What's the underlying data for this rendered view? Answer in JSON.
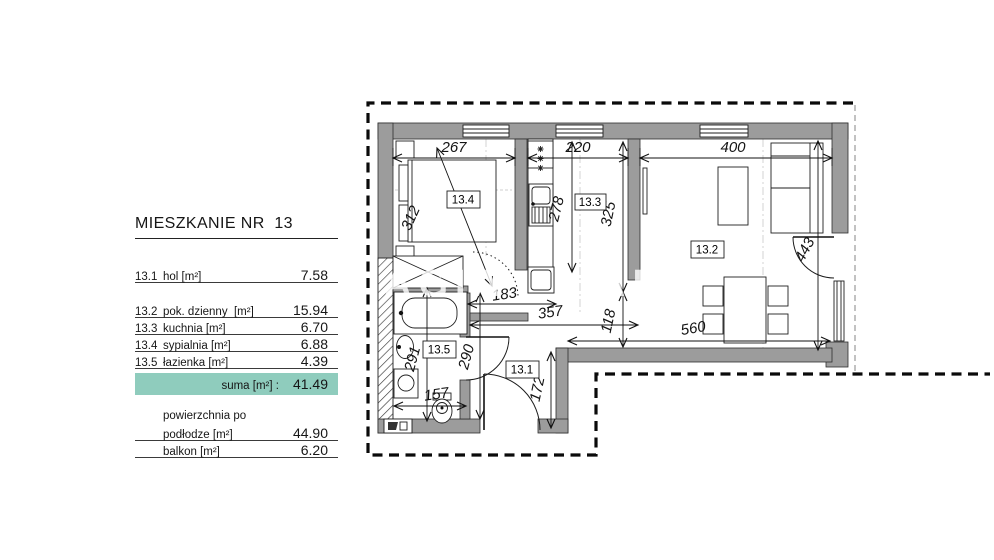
{
  "legend": {
    "title": "MIESZKANIE NR  13",
    "rows": [
      {
        "no": "13.1",
        "name": "hol [m²]",
        "value": "7.58"
      },
      {
        "no": "13.2",
        "name": "pok. dzienny  [m²]",
        "value": "15.94"
      },
      {
        "no": "13.3",
        "name": "kuchnia [m²]",
        "value": "6.70"
      },
      {
        "no": "13.4",
        "name": "sypialnia [m²]",
        "value": "6.88"
      },
      {
        "no": "13.5",
        "name": "łazienka [m²]",
        "value": "4.39"
      }
    ],
    "suma": {
      "label": "suma [m²] :",
      "value": "41.49"
    },
    "floor_area": {
      "line1": "powierzchnia po",
      "line2": "podłodze [m²]",
      "value": "44.90"
    },
    "balcony": {
      "name": "balkon [m²]",
      "value": "6.20"
    },
    "highlight_color": "#8fccbd"
  },
  "plan": {
    "labels": {
      "bedroom": "13.4",
      "kitchen": "13.3",
      "living": "13.2",
      "bath": "13.5",
      "hall": "13.1"
    },
    "dims": {
      "bedroom_width": "267",
      "kitchen_width": "220",
      "living_width": "400",
      "bedroom_depth": "312",
      "kitchen_depth": "278",
      "kitchen_total_depth": "325",
      "living_depth": "443",
      "hall_width": "183",
      "hall_living_width": "357",
      "passage_depth": "118",
      "living_bottom_width": "560",
      "bath_depth": "291",
      "hall_depth": "290",
      "bath_width": "157",
      "entry_depth": "172"
    },
    "watermark": [
      "AGIA",
      "AD"
    ],
    "wall_color": "#9c9c9c"
  }
}
